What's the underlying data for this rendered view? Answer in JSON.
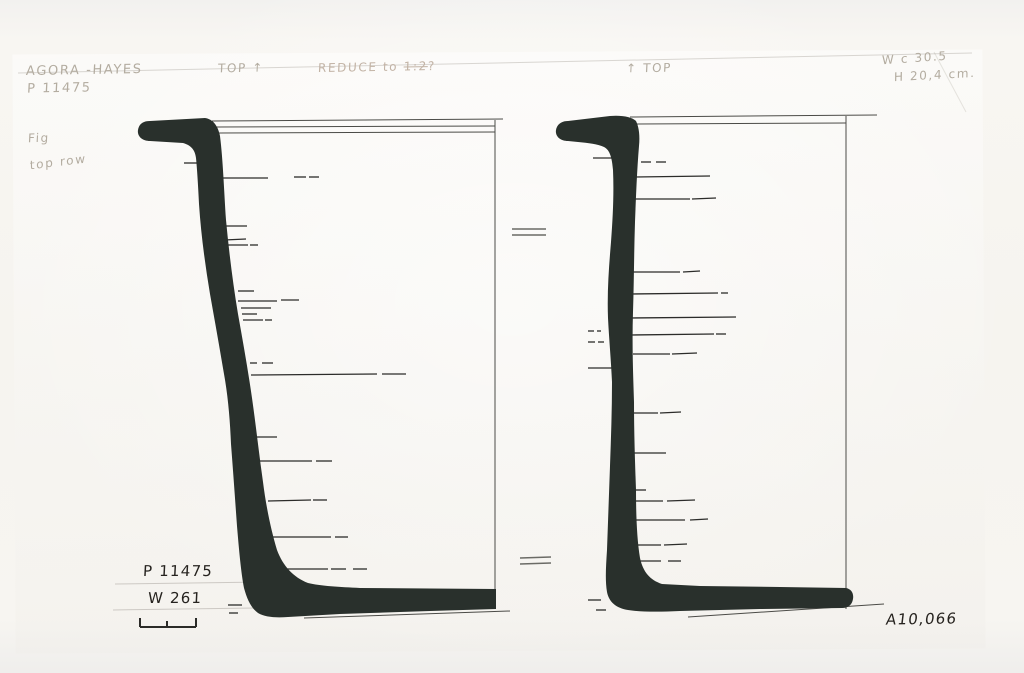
{
  "sheet": {
    "pencil_notes": {
      "site": "AGORA -HAYES",
      "catalog": "P 11475",
      "top_marker_left": "TOP ↑",
      "reduce_prefix": "REDUCE to ",
      "reduce_scale": "1:2",
      "reduce_suffix": "?",
      "top_marker_right": "↑ TOP",
      "width_note": "W c 30.5",
      "height_note": "H 20,4 cm.",
      "fig_note": "Fig",
      "row_note": "top row"
    },
    "ink_labels": {
      "catalog_number": "P 11475",
      "secondary_number": "W 261",
      "photo_number": "A10,066"
    },
    "colors": {
      "paper": "#f6f4ef",
      "profile_ink": "#29302c",
      "line_ink": "#3e3e3a",
      "pencil": "#b3aca0",
      "handwriting_ink": "#26231f"
    }
  }
}
